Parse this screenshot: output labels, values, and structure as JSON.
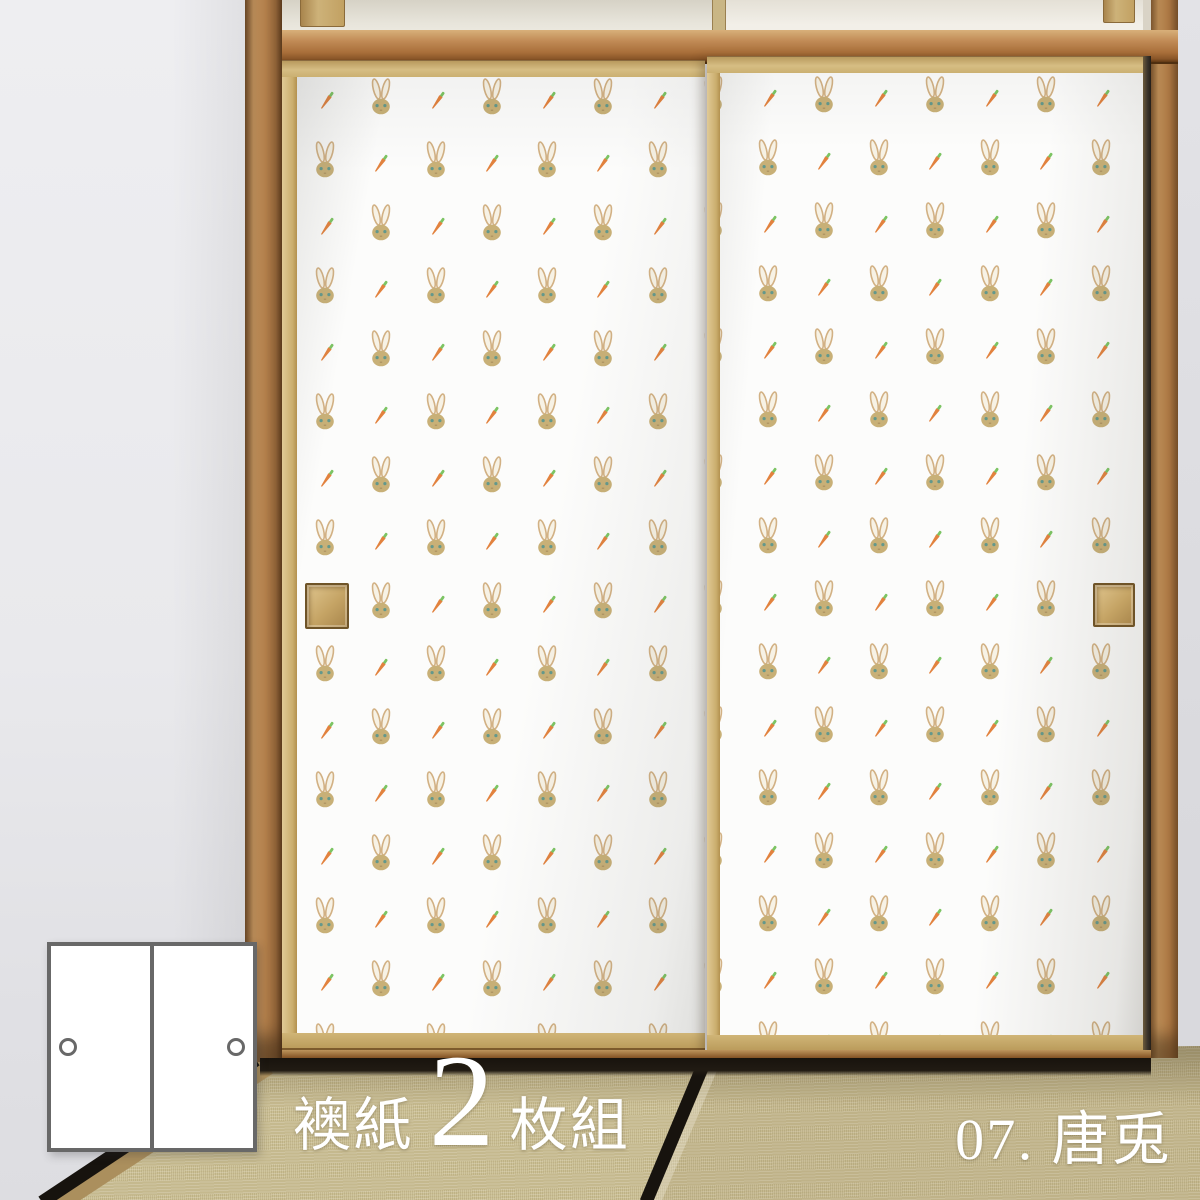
{
  "labels": {
    "set_material": "襖紙",
    "set_count": "2",
    "set_unit": "枚組",
    "pattern_number": "07. 唐兎"
  },
  "diagram": {
    "panel_count": 2,
    "panels": [
      {
        "name": "left-panel",
        "handle_side": "left"
      },
      {
        "name": "right-panel",
        "handle_side": "right"
      }
    ]
  },
  "pattern": {
    "name": "rabbit-and-carrot",
    "motifs": [
      "rabbit-icon",
      "carrot-icon"
    ]
  },
  "colors": {
    "wall": "#e9e9ec",
    "paper": "#fcfcfb",
    "wood": "#b5814c",
    "wood-dark": "#7a4e24",
    "wood-light": "#d5bc83",
    "rabbit-head": "#c8b077",
    "rabbit-ear-line": "#d2b184",
    "rabbit-ear-fill": "#f7f2e5",
    "rabbit-eye": "#63988b",
    "carrot-body": "#e2823e",
    "carrot-leaf": "#7cc463",
    "tatami": "#ccc095",
    "heri": "#17130e",
    "label-text": "#ffffff",
    "diagram-border": "#686868",
    "diagram-panel": "#ffffff"
  }
}
